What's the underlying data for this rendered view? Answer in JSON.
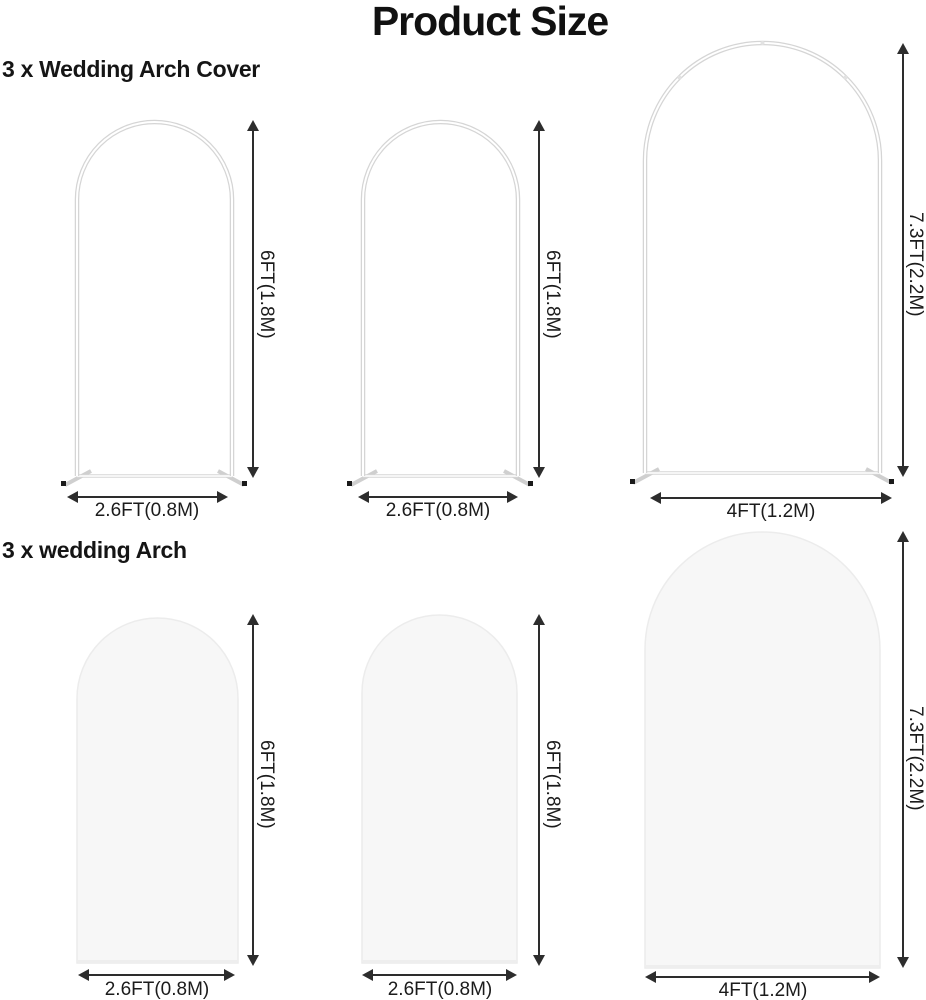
{
  "title": "Product Size",
  "sections": [
    {
      "label": "3 x Wedding Arch Cover",
      "type": "frame",
      "items": [
        {
          "name": "arch-frame-small-1",
          "height_label": "6FT(1.8M)",
          "width_label": "2.6FT(0.8M)"
        },
        {
          "name": "arch-frame-small-2",
          "height_label": "6FT(1.8M)",
          "width_label": "2.6FT(0.8M)"
        },
        {
          "name": "arch-frame-large",
          "height_label": "7.3FT(2.2M)",
          "width_label": "4FT(1.2M)"
        }
      ]
    },
    {
      "label": "3 x wedding Arch",
      "type": "solid-cover",
      "items": [
        {
          "name": "arch-cover-small-1",
          "height_label": "6FT(1.8M)",
          "width_label": "2.6FT(0.8M)"
        },
        {
          "name": "arch-cover-small-2",
          "height_label": "6FT(1.8M)",
          "width_label": "2.6FT(0.8M)"
        },
        {
          "name": "arch-cover-large",
          "height_label": "7.3FT(2.2M)",
          "width_label": "4FT(1.2M)"
        }
      ]
    }
  ],
  "colors": {
    "background": "#ffffff",
    "title_text": "#111111",
    "dimension_text": "#1b1b1b",
    "arrow": "#2d2d2d",
    "frame_tube": "#d5d5d5",
    "frame_foot_tip": "#1a1a1a",
    "cover_fill": "#f7f7f7",
    "cover_stroke": "#ececec"
  }
}
